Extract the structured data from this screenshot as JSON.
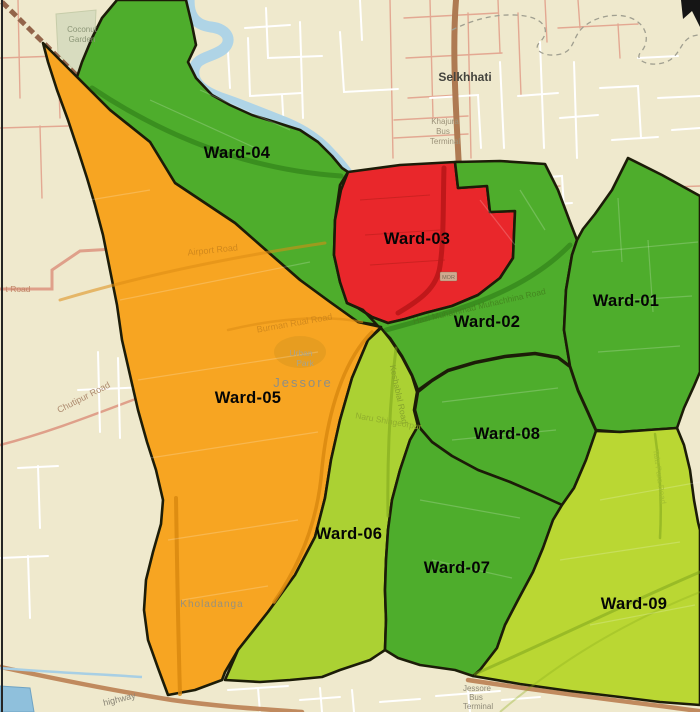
{
  "map": {
    "region_name": "Jessore",
    "boundary_color": "#1c1c08",
    "background_color": "#EFE9CD",
    "wards": [
      {
        "id": "ward-04",
        "label": "Ward-04",
        "color": "#4EAD2C",
        "label_x": 237,
        "label_y": 158
      },
      {
        "id": "ward-03",
        "label": "Ward-03",
        "color": "#E9272B",
        "label_x": 417,
        "label_y": 244
      },
      {
        "id": "ward-02",
        "label": "Ward-02",
        "color": "#4EAD2C",
        "label_x": 487,
        "label_y": 327
      },
      {
        "id": "ward-01",
        "label": "Ward-01",
        "color": "#4EAD2C",
        "label_x": 626,
        "label_y": 306
      },
      {
        "id": "ward-05",
        "label": "Ward-05",
        "color": "#F7A522",
        "label_x": 248,
        "label_y": 403
      },
      {
        "id": "ward-08",
        "label": "Ward-08",
        "color": "#4EAD2C",
        "label_x": 507,
        "label_y": 439
      },
      {
        "id": "ward-06",
        "label": "Ward-06",
        "color": "#ABD133",
        "label_x": 349,
        "label_y": 539
      },
      {
        "id": "ward-07",
        "label": "Ward-07",
        "color": "#4EAD2C",
        "label_x": 457,
        "label_y": 573
      },
      {
        "id": "ward-09",
        "label": "Ward-09",
        "color": "#BAD733",
        "label_x": 634,
        "label_y": 609
      }
    ],
    "labels": [
      {
        "name": "selkhhati",
        "text": "Selkhhati",
        "x": 465,
        "y": 81,
        "size": 12,
        "color": "#44443E",
        "bold": true
      },
      {
        "name": "khajura-line1",
        "text": "Khajura",
        "x": 445,
        "y": 124,
        "size": 8,
        "color": "#9B9179"
      },
      {
        "name": "khajura-line2",
        "text": "Bus",
        "x": 443,
        "y": 134,
        "size": 8,
        "color": "#9B9179"
      },
      {
        "name": "khajura-line3",
        "text": "Terminal",
        "x": 445,
        "y": 144,
        "size": 8,
        "color": "#9B9179"
      },
      {
        "name": "coconut-line1",
        "text": "Coconut",
        "x": 82,
        "y": 32,
        "size": 8,
        "color": "#8C9678"
      },
      {
        "name": "coconut-line2",
        "text": "Garden",
        "x": 82,
        "y": 42,
        "size": 8,
        "color": "#8C9678"
      },
      {
        "name": "jessore-city",
        "text": "Jessore",
        "x": 303,
        "y": 387,
        "size": 13,
        "color": "#8F8F85",
        "spacing": 2
      },
      {
        "name": "urban-park-line1",
        "text": "Urban",
        "x": 301,
        "y": 356,
        "size": 8.5,
        "color": "#A8A48B"
      },
      {
        "name": "urban-park-line2",
        "text": "Park",
        "x": 305,
        "y": 366,
        "size": 8.5,
        "color": "#A8A48B"
      },
      {
        "name": "kholadanga",
        "text": "Kholadanga",
        "x": 212,
        "y": 607,
        "size": 10,
        "color": "#97917D",
        "spacing": 1
      },
      {
        "name": "jessore-bus-terminal-line1",
        "text": "Jessore",
        "x": 477,
        "y": 691,
        "size": 8,
        "color": "#8F8A78"
      },
      {
        "name": "jessore-bus-terminal-line2",
        "text": "Bus",
        "x": 476,
        "y": 700,
        "size": 8,
        "color": "#8F8A78"
      },
      {
        "name": "jessore-bus-terminal-line3",
        "text": "Terminal",
        "x": 478,
        "y": 709,
        "size": 8,
        "color": "#8F8A78"
      },
      {
        "name": "highway",
        "text": "highway",
        "x": 120,
        "y": 702,
        "size": 9,
        "color": "#8A8576",
        "rot": -14
      },
      {
        "name": "t-road",
        "text": "t Road",
        "x": 18,
        "y": 292,
        "size": 8.5,
        "color": "#C08869"
      },
      {
        "name": "chutipur-road",
        "text": "Chutipur Road",
        "x": 85,
        "y": 400,
        "size": 9,
        "color": "#AD8A6E",
        "rot": -27
      },
      {
        "name": "airport-road",
        "text": "Airport Road",
        "x": 213,
        "y": 253,
        "size": 9,
        "color": "#C8811A",
        "opacity": 0.8,
        "rot": -6
      },
      {
        "name": "burman-rual-road",
        "text": "Burman Rual Road",
        "x": 295,
        "y": 326,
        "size": 9,
        "color": "#C8811A",
        "opacity": 0.75,
        "rot": -10
      },
      {
        "name": "hazi-muhammad-road",
        "text": "Hazi Muhammad Muhachhina Road",
        "x": 480,
        "y": 309,
        "size": 8.5,
        "color": "#417E1D",
        "opacity": 0.8,
        "rot": -13
      },
      {
        "name": "keshablal-road",
        "text": "Keshablal Road",
        "x": 396,
        "y": 395,
        "size": 8.5,
        "color": "#86A42C",
        "rot": 78
      },
      {
        "name": "naru-shingeorpur",
        "text": "Naru Shingeorpur",
        "x": 388,
        "y": 424,
        "size": 8.5,
        "color": "#90AE2D",
        "rot": 10
      },
      {
        "name": "tala-para-road",
        "text": "Tala Para Road",
        "x": 657,
        "y": 477,
        "size": 8,
        "color": "#A3C030",
        "rot": 82
      },
      {
        "name": "mor",
        "text": "MOR",
        "x": 448.5,
        "y": 279,
        "size": 5.5,
        "color": "#7A6A55"
      }
    ],
    "icons": {
      "north_arrow": "north-arrow-fragment"
    },
    "water": {
      "river_color": "#AFD4E6",
      "pond_color": "#8FC0DC"
    }
  }
}
